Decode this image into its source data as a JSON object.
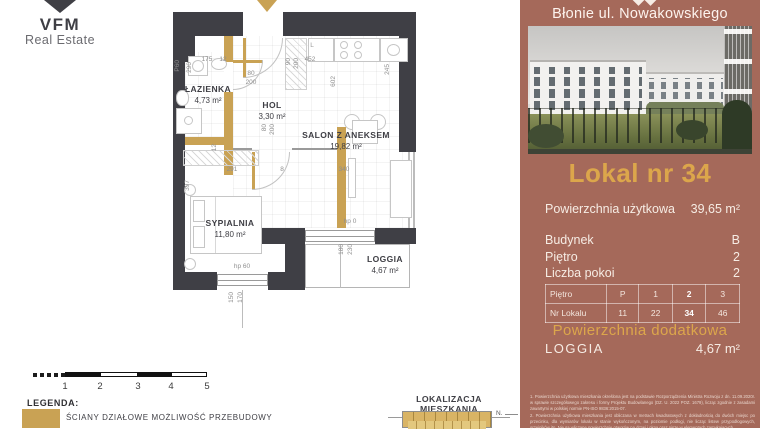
{
  "logo": {
    "name": "VFM",
    "subtitle": "Real Estate"
  },
  "plan": {
    "rooms": {
      "bathroom": {
        "name": "ŁAZIENKA",
        "area": "4,73 m²"
      },
      "hall": {
        "name": "HOL",
        "area": "3,30 m²"
      },
      "living": {
        "name": "SALON Z ANEKSEM",
        "area": "19,82 m²"
      },
      "bedroom": {
        "name": "SYPIALNIA",
        "area": "11,80 m²"
      },
      "loggia": {
        "name": "LOGGIA",
        "area": "4,67 m²"
      }
    },
    "dims": {
      "bath_width": "175",
      "wall_top": "12",
      "kitchen_wall": "452",
      "right_side": "245",
      "living_depth": "602",
      "entry_door_w": "90",
      "entry_door_h": "200",
      "bath_door_w": "80",
      "bath_door_h": "200",
      "bed_door_w": "80",
      "bed_door_h": "200",
      "pipe": "P60",
      "bath_depth": "290",
      "wall_left": "12",
      "bed_width": "291",
      "wall_mid": "8",
      "living_width": "340",
      "bed_depth": "397",
      "loggia_hp": "hp 0",
      "loggia_win_w": "180",
      "loggia_win_h": "230",
      "bed_hp": "hp 60",
      "bed_win_w": "150",
      "bed_win_h": "170",
      "fridge": "L"
    }
  },
  "legend": {
    "title": "LEGENDA:",
    "item": "ŚCIANY DZIAŁOWE MOŻLIWOŚĆ PRZEBUDOWY",
    "ticks": [
      "1",
      "2",
      "3",
      "4",
      "5"
    ]
  },
  "location": {
    "title": "LOKALIZACJA MIESZKANIA",
    "north": "N."
  },
  "panel": {
    "project": "Błonie ul. Nowakowskiego",
    "title": "Lokal nr 34",
    "specs": [
      {
        "label": "Powierzchnia użytkowa",
        "value": "39,65 m²"
      },
      {
        "label": "Budynek",
        "value": "B"
      },
      {
        "label": "Piętro",
        "value": "2"
      },
      {
        "label": "Liczba pokoi",
        "value": "2"
      }
    ],
    "table": {
      "rows": [
        {
          "label": "Piętro",
          "cells": [
            "P",
            "1",
            "2",
            "3"
          ]
        },
        {
          "label": "Nr Lokalu",
          "cells": [
            "11",
            "22",
            "34",
            "46"
          ]
        }
      ]
    },
    "additional_title": "Powierzchnia dodatkowa",
    "additional": {
      "label": "LOGGIA",
      "value": "4,67 m²"
    },
    "footnotes": [
      "1. Powierzchnia użytkowa mieszkania określona jest na podstawie Rozporządzenia Ministra Rozwoju z dn. 11.09.2020r. w sprawie szczegółowego zakresu i formy Projektu Budowlanego (DZ. U. 2022 POZ. 1679), licząc zgodnie z zasadami zawartymi w polskiej normie PN-ISO 9836:2015-07.",
      "2. Powierzchnia użytkowa mieszkania jest obliczana w metrach kwadratowych z dokładnością do dwóch miejsc po przecinku, dla wymiarów lokalu w stanie wykończonym, na poziomie podłogi, nie licząc listew przypodłogowych, grzejników itp. Nie są wliczane powierzchnie otworów na drzwi i okna oraz nisze w elementach zamykających."
    ]
  }
}
